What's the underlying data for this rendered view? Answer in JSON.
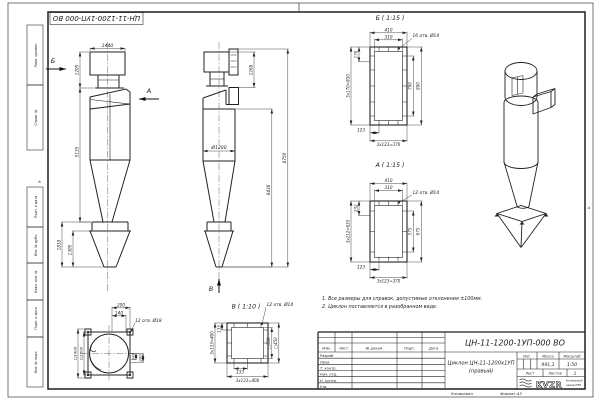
{
  "sheet": {
    "designation_flipped": "ЦН-11-1200-1УП-000 ВО",
    "margin_fields": {
      "perv_primen": "Перв. примен.",
      "sprav_no": "Справ. №",
      "podp_data_1": "Подп. и дата",
      "inv_dubl": "Инв. № дубл.",
      "vzam_inv": "Взам. инв. №",
      "podp_data_2": "Подп. и дата",
      "inv_podl": "Инв. № подл."
    },
    "zone_marker_left": "А",
    "zone_marker_right": "А",
    "copy_label": "Копировал",
    "format_label": "Формат А3"
  },
  "notes": {
    "line1": "1. Все размеры для справок, допустимые отклонения ±100мм.",
    "line2": "2. Циклон поставляется в разобранном виде."
  },
  "front_view": {
    "arrow_b": "Б",
    "arrow_a": "А",
    "dim_top_width": "1440",
    "dim_upper_height": "1205",
    "dim_body_height": "5135",
    "dim_hopper_total": "1810",
    "dim_hopper_cone": "1305"
  },
  "side_view": {
    "dim_outlet_height": "1269",
    "dim_diameter": "Ø1200",
    "dim_total_height": "8750",
    "dim_lower_height": "6436",
    "arrow_v": "В"
  },
  "detail_b": {
    "title": "Б ( 1:15 )",
    "holes_note": "16 отв. Ø14",
    "dim_410": "410",
    "dim_310": "310",
    "dim_170": "170",
    "dim_pitch_v": "5х170=850",
    "dim_790": "790",
    "dim_890": "890",
    "dim_123": "123",
    "dim_pitch_h": "3х123=370"
  },
  "detail_a": {
    "title": "А ( 1:15 )",
    "holes_note": "12 отв. Ø14",
    "dim_410": "410",
    "dim_310": "310",
    "dim_232": "232",
    "dim_pitch_v": "3х212=635",
    "dim_575": "575",
    "dim_675": "675",
    "dim_123": "123",
    "dim_pitch_h": "3х123=370"
  },
  "detail_v": {
    "title": "В ( 1:10 )",
    "holes_note": "12 отв. Ø14",
    "dim_133_left": "133",
    "dim_pitch_left": "3х133=400",
    "dim_sq350": "□350",
    "dim_sq450": "□450",
    "dim_133_bottom": "133",
    "dim_pitch_bottom": "3х133=400"
  },
  "plan_view": {
    "dim_200_top": "200",
    "dim_140_top": "140",
    "holes_note": "12 отв. Ø18",
    "dim_140_right": "140",
    "dim_200_right": "200",
    "dim_sq1406": "□1406",
    "dim_sq1200": "□1200"
  },
  "title_block": {
    "designation": "ЦН-11-1200-1УП-000 ВО",
    "name_line1": "Циклон ЦН-11-1200х1УП",
    "name_line2": "(правый)",
    "col_izm": "Изм.",
    "col_list": "Лист",
    "col_doc": "№ докум.",
    "col_sign": "Подп.",
    "col_date": "Дата",
    "row_razrab": "Разраб.",
    "row_prov": "Пров.",
    "row_tkontr": "Т. контр.",
    "row_nachotd": "Нач. отд.",
    "row_nkontr": "Н. контр.",
    "row_utv": "Утв.",
    "lit_label": "Лит.",
    "mass_label": "Масса",
    "scale_label": "Масштаб",
    "mass_value": "991,3",
    "scale_value": "1:50",
    "sheet_label": "Лист",
    "sheets_label": "Листов",
    "sheets_value": "1",
    "logo_text": "KVZR",
    "company_line1": "Котельный",
    "company_line2": "завод РЭП"
  }
}
